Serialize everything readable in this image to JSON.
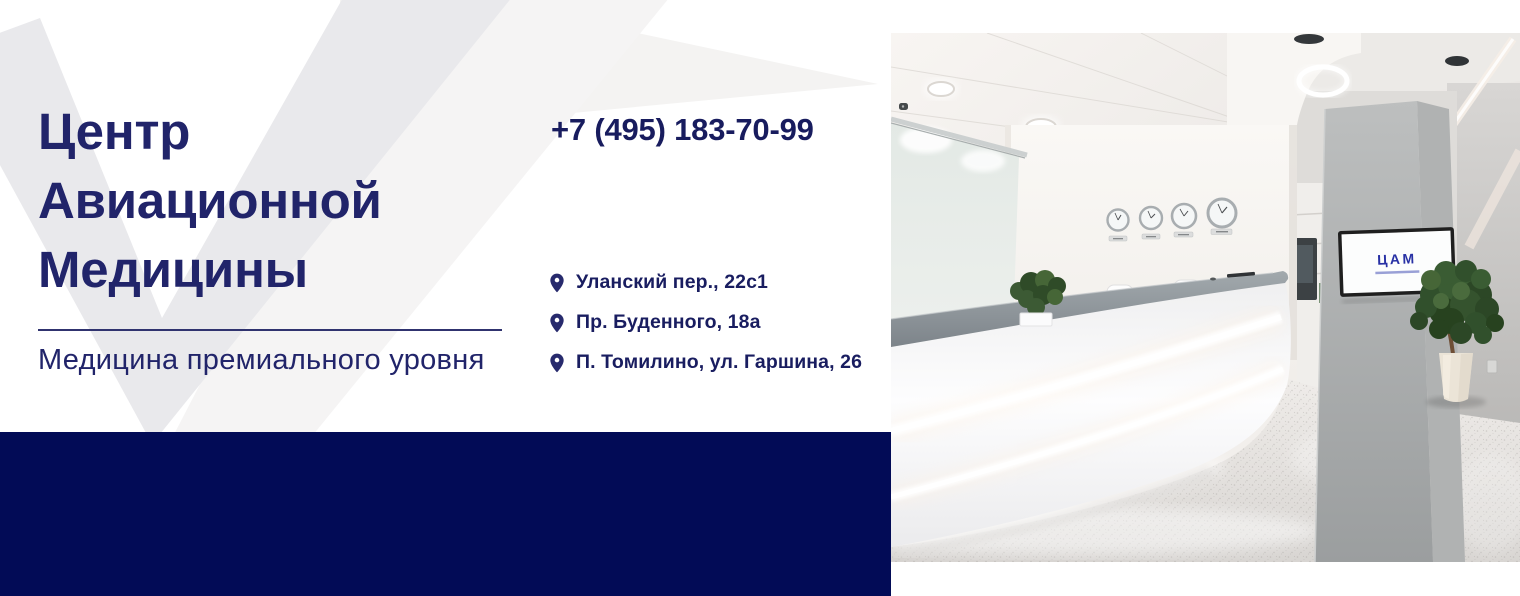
{
  "brand": {
    "title_line1": "Центр",
    "title_line2": "Авиационной",
    "title_line3": "Медицины",
    "tagline": "Медицина премиального уровня"
  },
  "contact": {
    "phone": "+7 (495) 183-70-99",
    "addresses": [
      "Уланский пер., 22с1",
      "Пр. Буденного, 18а",
      "П. Томилино, ул. Гаршина, 26"
    ]
  },
  "photo": {
    "tv_logo": "ЦАМ"
  },
  "colors": {
    "navy_text": "#21246a",
    "navy_bar": "#020b56",
    "watermark_gray": "#e9e9ec",
    "watermark_light": "#f4f3f2"
  }
}
